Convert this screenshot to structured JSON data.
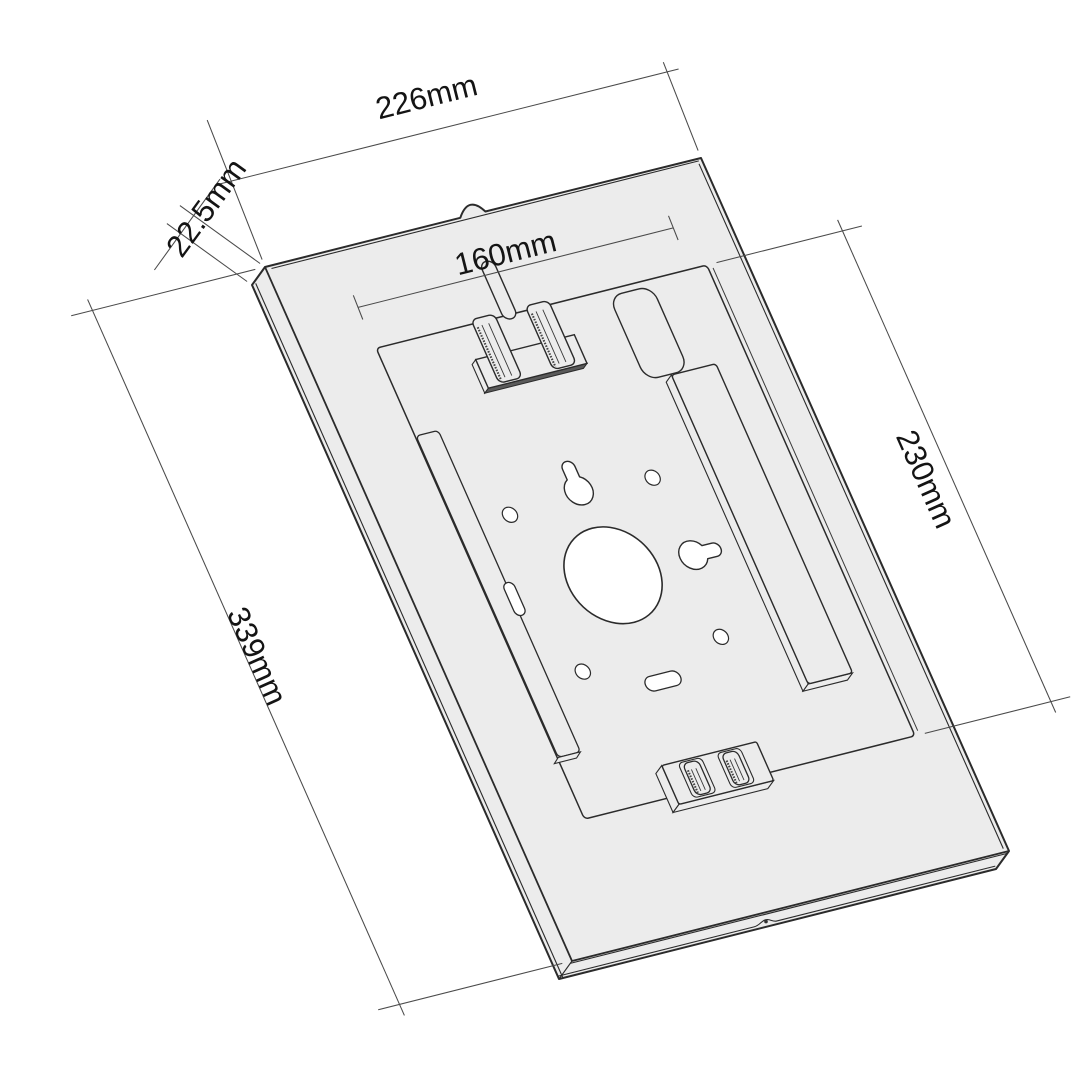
{
  "drawing": {
    "part_name": "tablet-enclosure-back-view",
    "style": "monochrome line drawing, axonometric projection",
    "background": "#ffffff",
    "part_fill": "#ececec",
    "line_color": "#2b2b2b",
    "dim_line_color": "#4a4a4a",
    "text_color": "#141414",
    "dimensions": [
      {
        "id": "outer-width",
        "label": "226mm",
        "value": 226,
        "unit": "mm"
      },
      {
        "id": "depth",
        "label": "22.5mm",
        "value": 22.5,
        "unit": "mm"
      },
      {
        "id": "window-width",
        "label": "160mm",
        "value": 160,
        "unit": "mm"
      },
      {
        "id": "recess-height",
        "label": "230mm",
        "value": 230,
        "unit": "mm"
      },
      {
        "id": "outer-height",
        "label": "339mm",
        "value": 339,
        "unit": "mm"
      }
    ]
  }
}
